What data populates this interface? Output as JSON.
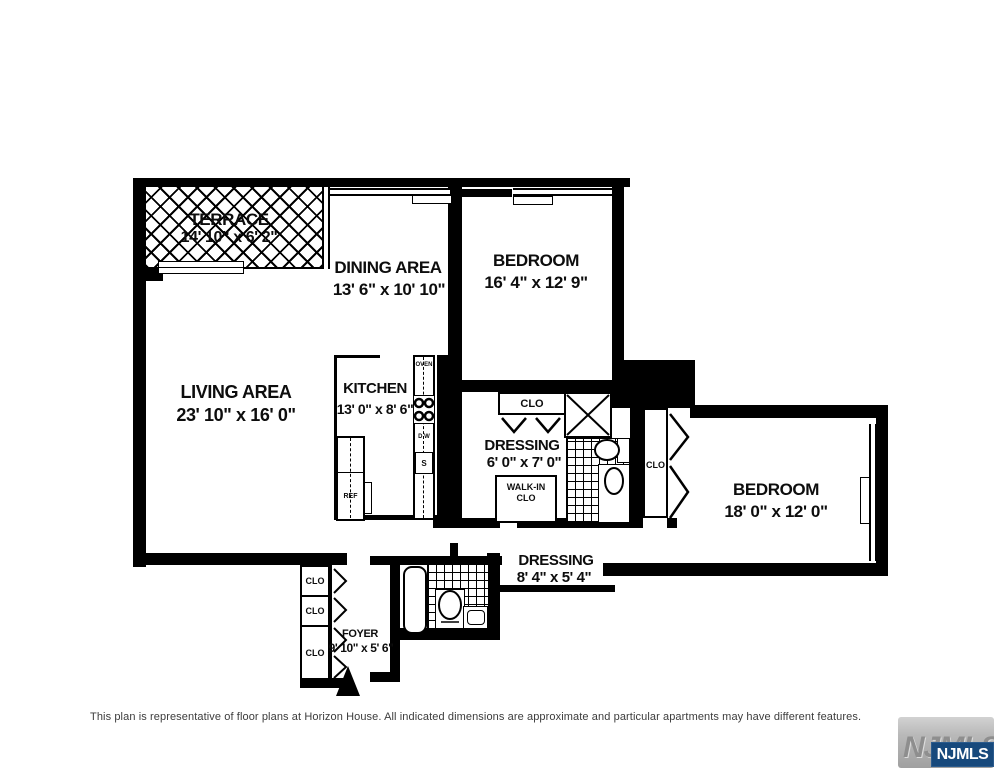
{
  "plan": {
    "rooms": {
      "terrace": {
        "name": "TERRACE",
        "dims": "14' 10\" x 6' 2\""
      },
      "dining": {
        "name": "DINING AREA",
        "dims": "13' 6\" x 10' 10\""
      },
      "bedroom1": {
        "name": "BEDROOM",
        "dims": "16' 4\" x 12' 9\""
      },
      "living": {
        "name": "LIVING AREA",
        "dims": "23' 10\" x 16' 0\""
      },
      "kitchen": {
        "name": "KITCHEN",
        "dims": "13' 0\" x 8' 6\""
      },
      "dressing1": {
        "name": "DRESSING",
        "dims": "6' 0\" x 7' 0\""
      },
      "dressing2": {
        "name": "DRESSING",
        "dims": "8' 4\" x 5' 4\""
      },
      "bedroom2": {
        "name": "BEDROOM",
        "dims": "18' 0\" x 12' 0\""
      },
      "foyer": {
        "name": "FOYER",
        "dims": "9' 10\" x 5' 6\""
      }
    },
    "closets": {
      "clo": "CLO",
      "walkin_line1": "WALK-IN",
      "walkin_line2": "CLO"
    },
    "appliances": {
      "oven": "OVEN",
      "dishwasher": "D W",
      "sink": "S",
      "refrigerator": "REF"
    }
  },
  "footer": {
    "disclaimer": "This plan is representative of floor plans at Horizon House. All indicated dimensions are approximate and particular apartments may have different features."
  },
  "watermark": {
    "mls_gray": "NJMLS",
    "mls_badge": "NJMLS"
  }
}
